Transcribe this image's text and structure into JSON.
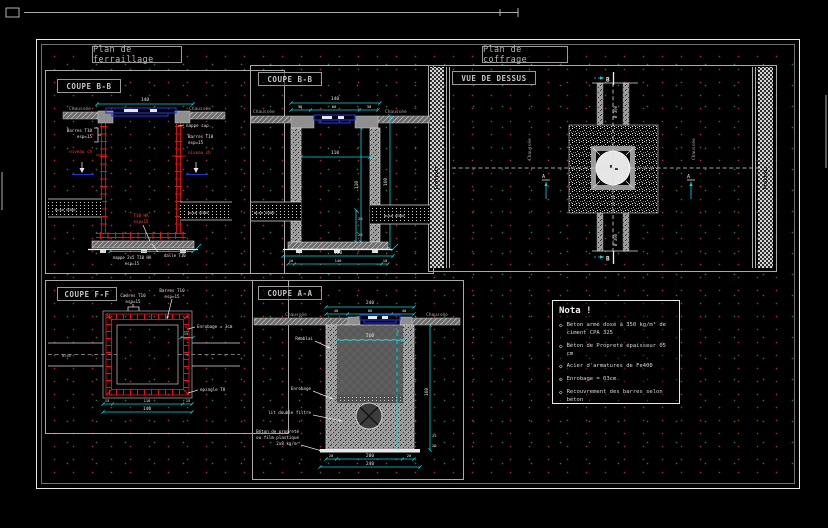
{
  "headers": {
    "left": "Plan de ferraillage",
    "right": "Plan de coffrage"
  },
  "p1": {
    "title": "COUPE B-B",
    "dim_top": "140",
    "chaussee_l": "Chaussée",
    "chaussee_r": "Chaussée",
    "barres1": "Barres T10",
    "barres2": "esp=15",
    "niveau_l": "niveau ch",
    "niveau_r": "niveau ch",
    "nappe_sup": "nappe sup.",
    "rbarres1": "Barres T10",
    "rbarres2": "esp=15",
    "center1": "T10 HA",
    "center2": "esp=15",
    "pipe_l": "buse Ø300",
    "pipe_r": "buse Ø300",
    "nappe1": "nappe 2x5 T10 HA",
    "nappe2": "esp=15",
    "dalle": "dalle T10"
  },
  "p2": {
    "title": "COUPE F-F",
    "cadres1": "Cadres T10",
    "cadres2": "esp=15",
    "barres1": "Barres T10",
    "barres2": "esp=15",
    "enrobage": "Enrobage = 3cm",
    "dim15": "15",
    "epingle": "epingle T8",
    "d1": "15",
    "d2": "110",
    "d3": "15",
    "total": "140",
    "pipe": "Ø300"
  },
  "p3": {
    "title": "COUPE B-B",
    "total": "140",
    "s1": "30",
    "s2": "80",
    "s3": "30",
    "chaussee_l": "Chaussée",
    "chaussee_r": "Chaussée",
    "inner": "110",
    "h_inner": "110",
    "h_outer": "160",
    "d20a": "20",
    "d20b": "20",
    "pipe_l": "buse Ø300",
    "pipe_r": "buse Ø300",
    "slab_total": "160",
    "b1": "10",
    "b2": "140",
    "b3": "10"
  },
  "p4": {
    "title": "VUE DE DESSUS",
    "trottoir_l": "Trottoir",
    "trottoir_r": "Trottoir",
    "chaussee_l": "Chaussée",
    "chaussee_r": "Chaussée",
    "pipe_top": "Ø 300",
    "pipe_bot": "Ø 300",
    "b_top": "B",
    "b_bot": "B",
    "a_left": "A",
    "a_right": "A"
  },
  "p5": {
    "title": "COUPE A-A",
    "chaussee_l": "Chaussée",
    "chaussee_r": "Chaussée",
    "total_top": "240",
    "s1": "40",
    "s2": "80",
    "s3": "40",
    "inner": "200",
    "h": "160",
    "d25": "25",
    "d20": "20",
    "remblai": "Remblai",
    "enrobage": "Enrobage",
    "filtre": "lit double filtre",
    "bp1": "Béton de propreté",
    "bp2": "ou film plastique",
    "bp3": "2x8 kg/m³",
    "bd1": "20",
    "bd2": "200",
    "bd3": "20",
    "total_bottom": "240"
  },
  "nota": {
    "title": "Nota !",
    "bullet": "◇",
    "items": [
      "Béton armé dosé à 350 kg/m³ de ciment CPA 325",
      "Béton de Propreté épaisseur 05 cm",
      "Acier d'armatures de Fe400",
      "Enrobage = 03cm",
      "Recouvrement des barres selon béton"
    ]
  }
}
